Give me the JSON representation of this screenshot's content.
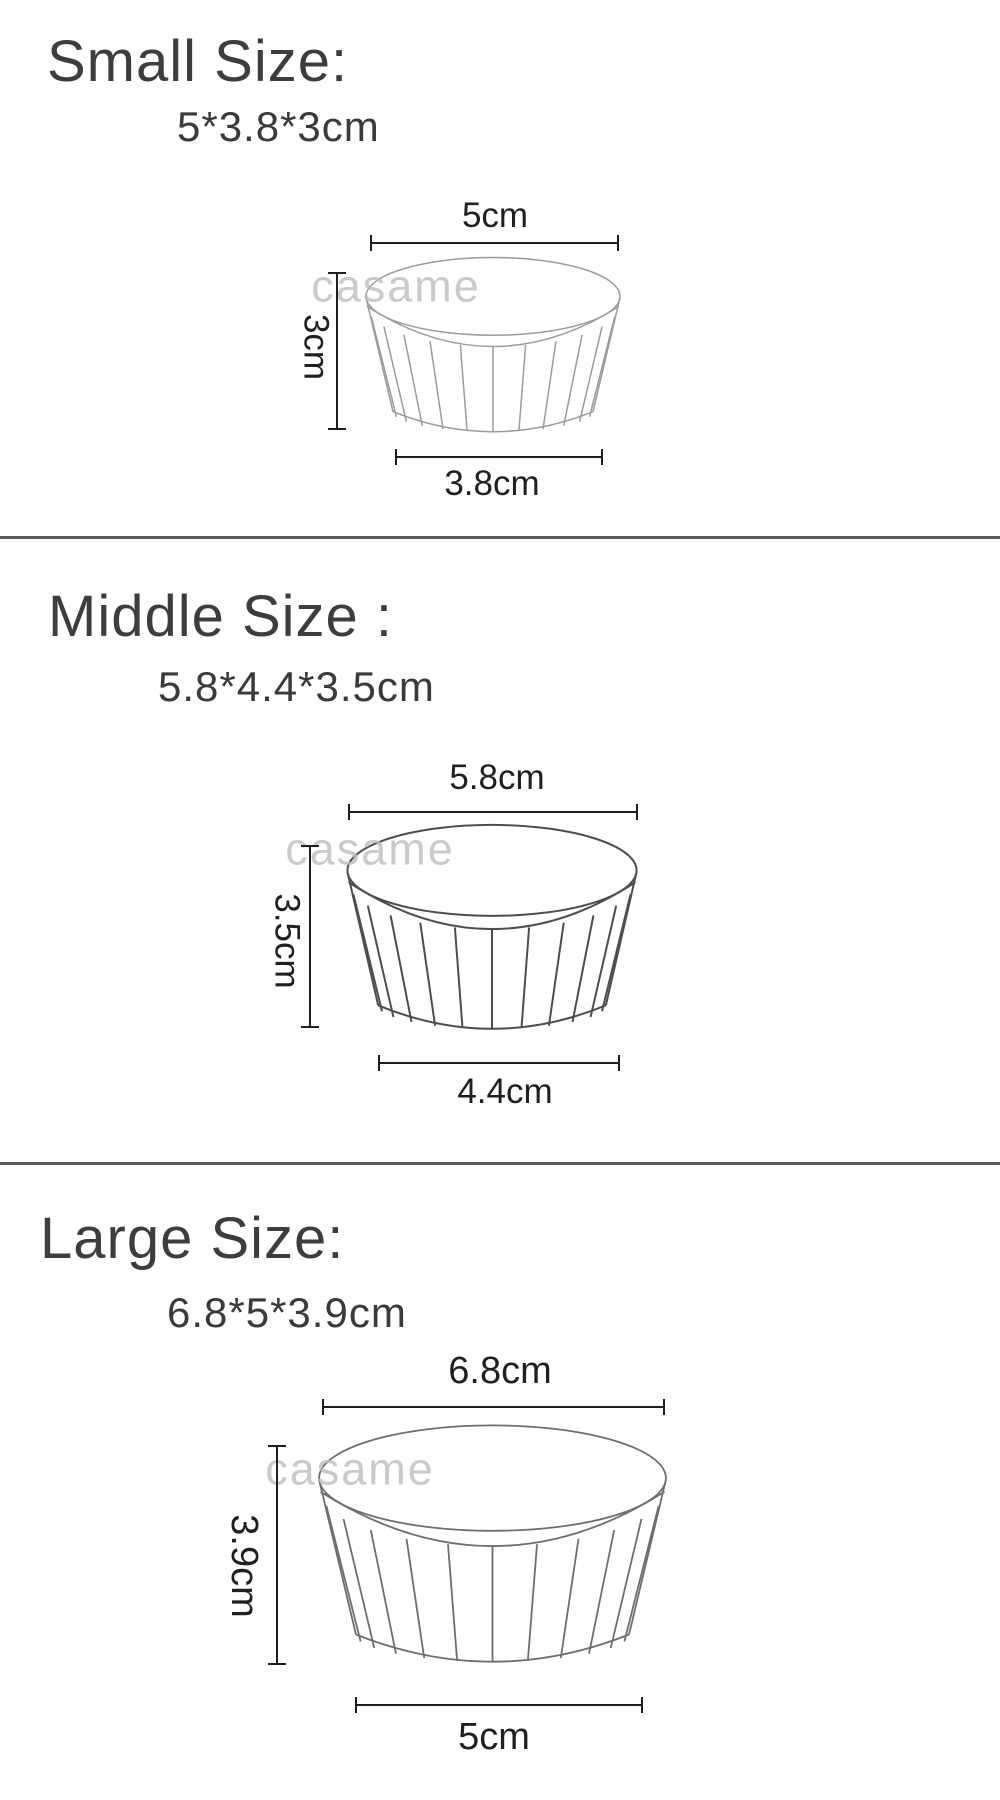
{
  "colors": {
    "background": "#ffffff",
    "heading_text": "#3d3d3d",
    "dimension_text": "#1f1f1f",
    "divider": "#5a5a5a",
    "watermark": "#bdbdbd",
    "cup_line_small": "#9b9b9b",
    "cup_line_middle": "#4d4d4d",
    "cup_line_large": "#6e6e6e"
  },
  "sections": [
    {
      "heading": "Small Size:",
      "size_text": "5*3.8*3cm",
      "top_width_label": "5cm",
      "height_label": "3cm",
      "bottom_width_label": "3.8cm",
      "watermark": "casame"
    },
    {
      "heading": "Middle Size :",
      "size_text": "5.8*4.4*3.5cm",
      "top_width_label": "5.8cm",
      "height_label": "3.5cm",
      "bottom_width_label": "4.4cm",
      "watermark": "casame"
    },
    {
      "heading": "Large Size:",
      "size_text": "6.8*5*3.9cm",
      "top_width_label": "6.8cm",
      "height_label": "3.9cm",
      "bottom_width_label": "5cm",
      "watermark": "casame"
    }
  ]
}
